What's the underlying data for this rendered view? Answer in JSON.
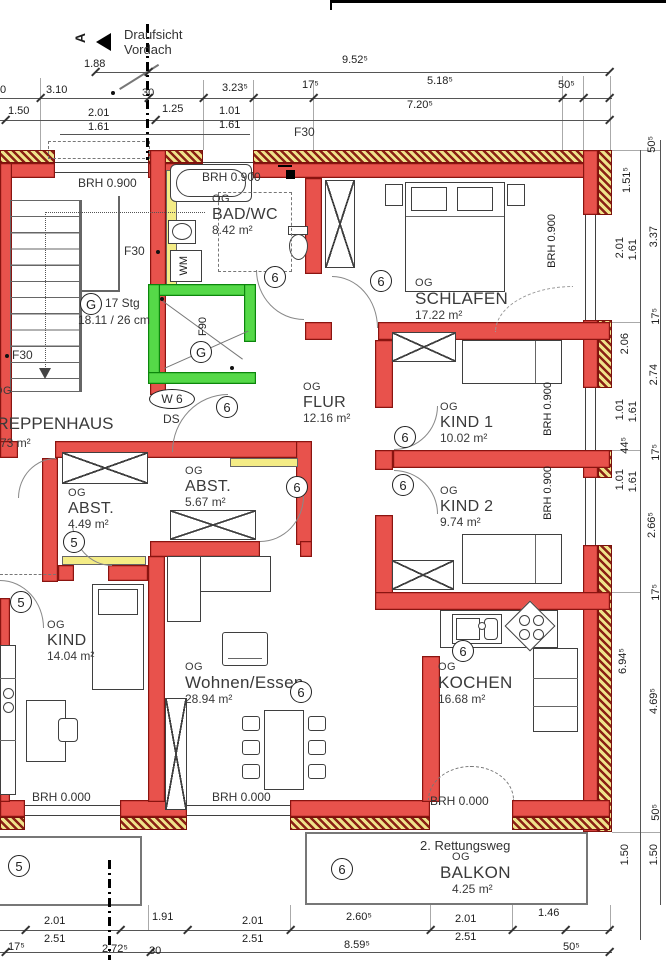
{
  "header": {
    "vordach_line1": "Draufsicht",
    "vordach_line2": "Vordach",
    "section_letter": "A"
  },
  "rooms": {
    "treppenhaus": {
      "og": "OG",
      "name": "TREPPENHAUS",
      "area": "3.73 m²"
    },
    "badwc": {
      "og": "OG",
      "name": "BAD/WC",
      "area": "8.42 m²"
    },
    "schlafen": {
      "og": "OG",
      "name": "SCHLAFEN",
      "area": "17.22 m²"
    },
    "flur": {
      "og": "OG",
      "name": "FLUR",
      "area": "12.16 m²"
    },
    "kind1": {
      "og": "OG",
      "name": "KIND 1",
      "area": "10.02 m²"
    },
    "kind2": {
      "og": "OG",
      "name": "KIND 2",
      "area": "9.74 m²"
    },
    "abst6": {
      "og": "OG",
      "name": "ABST.",
      "area": "5.67 m²"
    },
    "abst5": {
      "og": "OG",
      "name": "ABST.",
      "area": "4.49 m²"
    },
    "kind5": {
      "og": "OG",
      "name": "KIND",
      "area": "14.04 m²"
    },
    "wohnen": {
      "og": "OG",
      "name": "Wohnen/Essen",
      "area": "28.94 m²"
    },
    "kochen": {
      "og": "OG",
      "name": "KOCHEN",
      "area": "16.68 m²"
    },
    "balkon": {
      "og": "OG",
      "name": "BALKON",
      "area": "4.25 m²"
    }
  },
  "units": {
    "five": "5",
    "six": "6"
  },
  "annotations": {
    "stair_circle": "G",
    "stair_count": "17 Stg",
    "stair_ratio": "18.11 / 26 cm",
    "f30": "F30",
    "f90": "F90",
    "lift_circle": "G",
    "w6": "W 6",
    "ds": "DS",
    "wm": "WM",
    "brh_090": "BRH 0.900",
    "brh_000": "BRH 0.000",
    "rettungsweg": "2. Rettungsweg"
  },
  "dims": {
    "top": [
      "1.88",
      "9.52⁵",
      "0",
      "3.10",
      "30",
      "3.23⁵",
      "17⁵",
      "5.18⁵",
      "50⁵",
      "1.50",
      "2.01",
      "1.25",
      "1.01",
      "7.20⁵",
      "1.61",
      "1.61"
    ],
    "bottom": [
      "2.01",
      "1.91",
      "2.01",
      "2.60⁵",
      "2.01",
      "1.46",
      "2.51",
      "2.51",
      "2.51",
      "17⁵",
      "2.72⁵",
      "30",
      "8.59⁵",
      "50⁵"
    ],
    "right_inner": [
      "1.51⁵",
      "2.01",
      "1.61",
      "2.06",
      "1.01",
      "1.61",
      "44⁵",
      "1.01",
      "1.61",
      "6.94⁵",
      "1.50"
    ],
    "right_outer": [
      "50⁵",
      "3.37",
      "17⁵",
      "2.74",
      "17⁵",
      "2.66⁵",
      "17⁵",
      "4.69⁵",
      "50⁵",
      "1.50"
    ]
  },
  "colors": {
    "wall_red": "#e8524c",
    "wall_outline": "#8a1410",
    "insulation_yellow": "#efe38a",
    "lift_green": "#55d948",
    "panel_yellow": "#f4ec86"
  }
}
